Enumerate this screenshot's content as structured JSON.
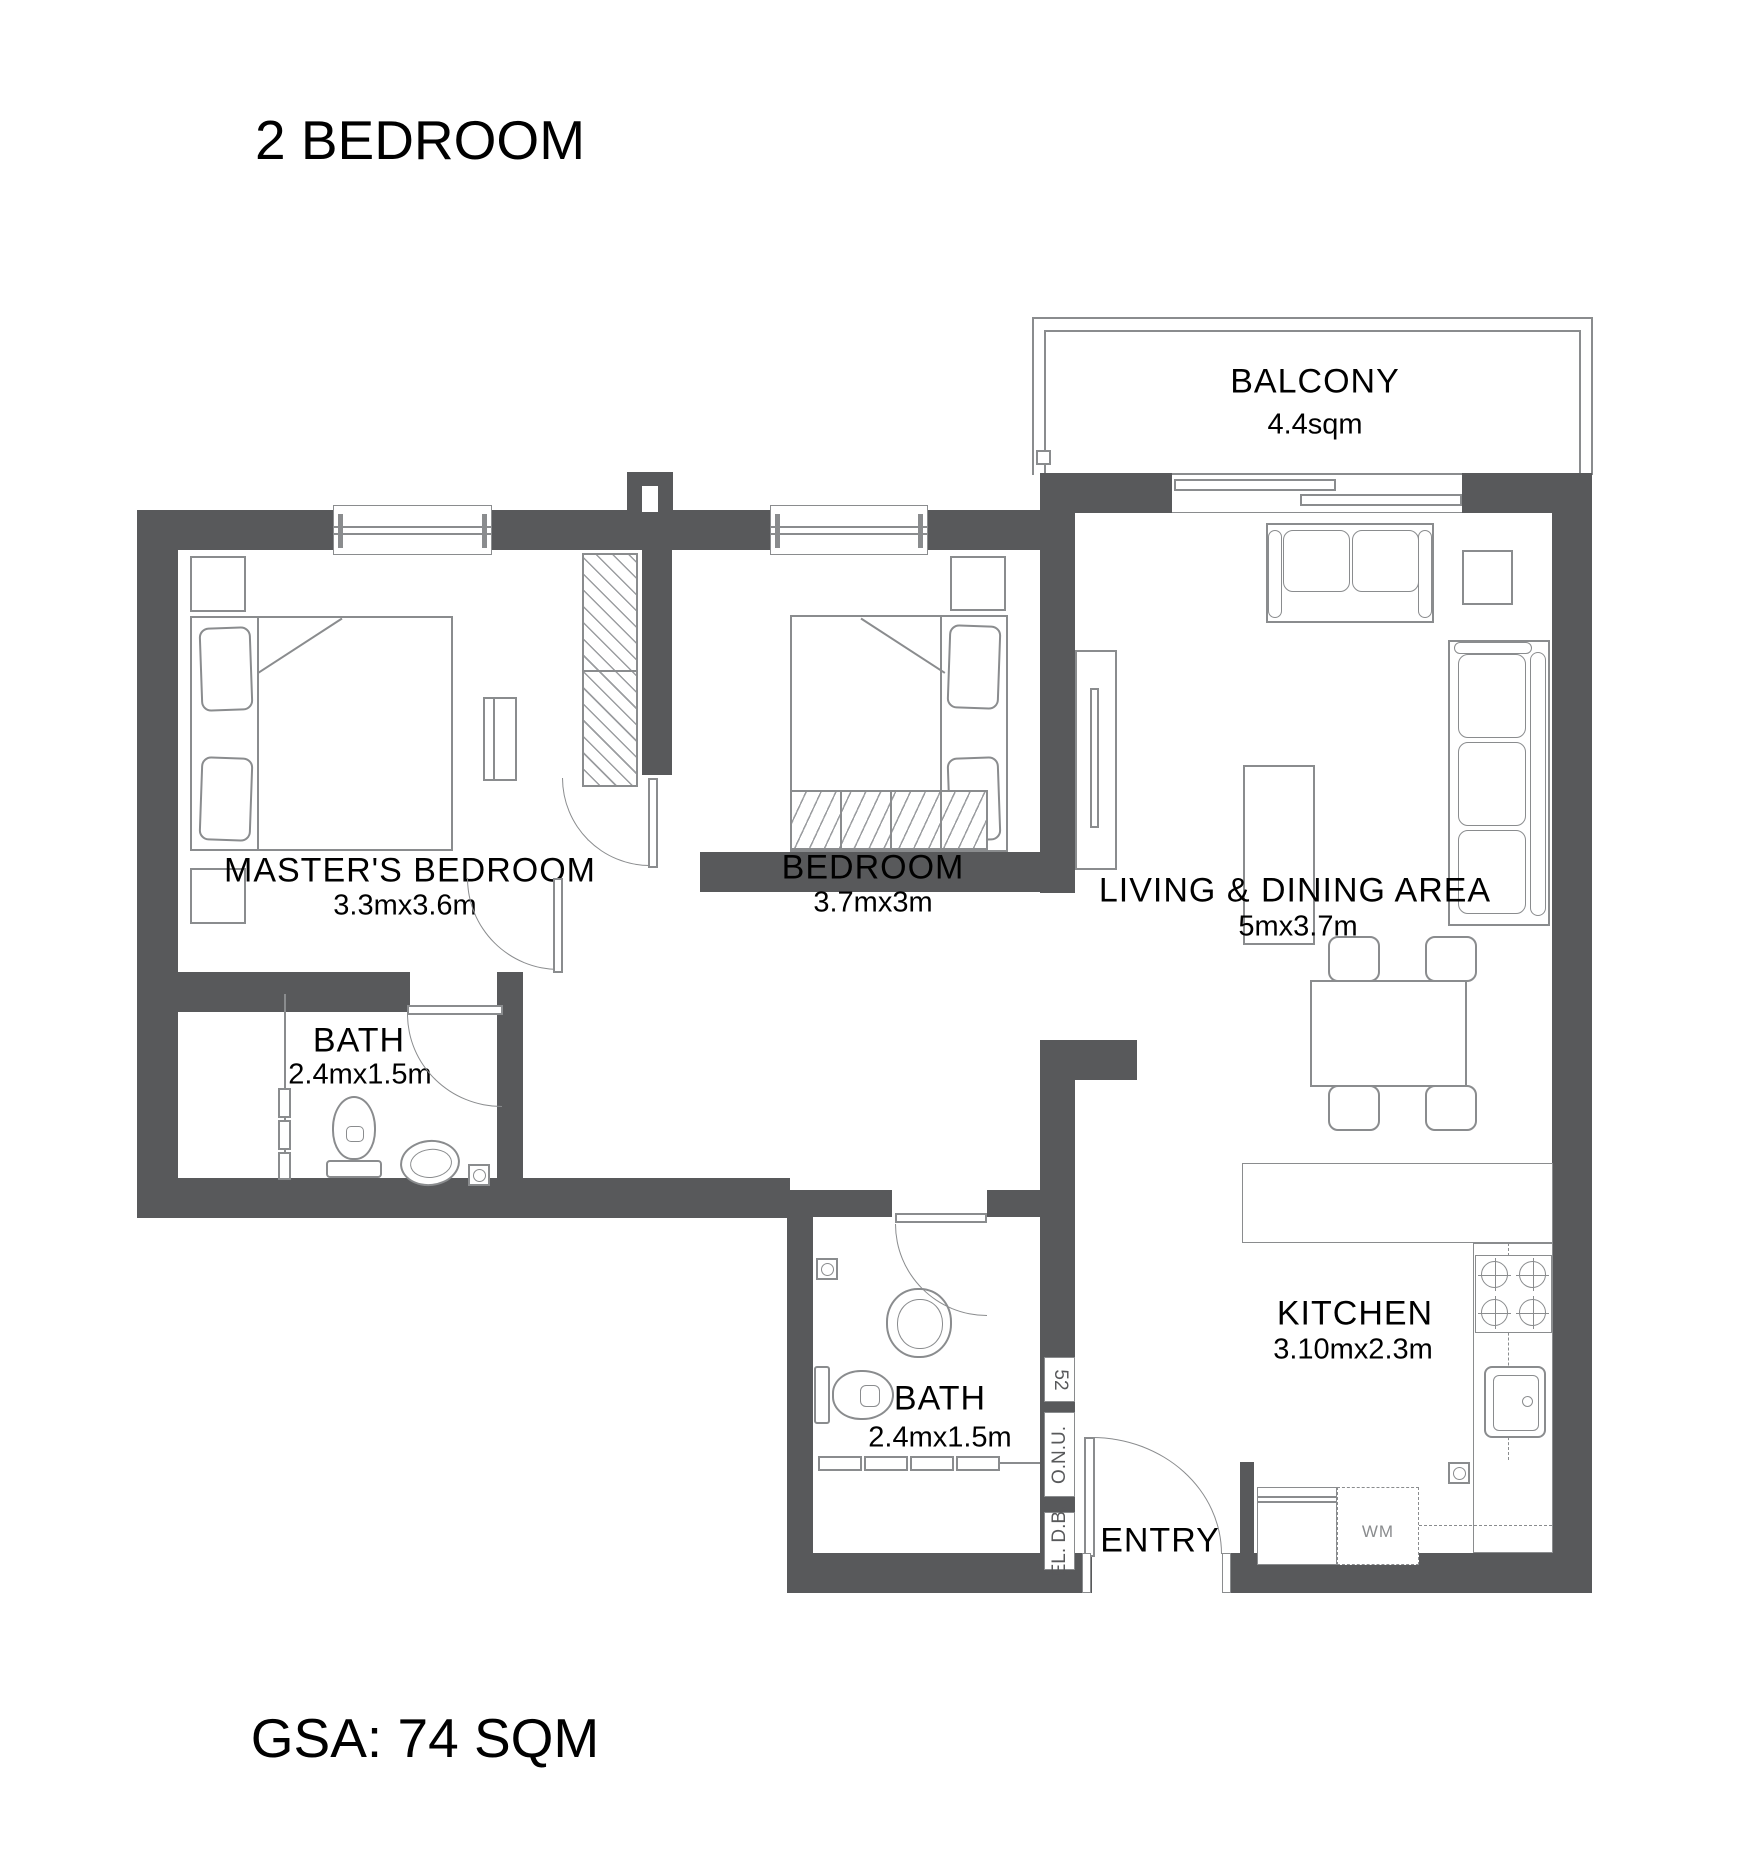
{
  "title": "2 BEDROOM",
  "footer": "GSA: 74 SQM",
  "colors": {
    "wall": "#58595b",
    "furniture_line": "#8a8c8e",
    "text": "#000000"
  },
  "rooms": {
    "balcony": {
      "name": "BALCONY",
      "dims": "4.4sqm"
    },
    "master_bedroom": {
      "name": "MASTER'S BEDROOM",
      "dims": "3.3mx3.6m"
    },
    "bedroom": {
      "name": "BEDROOM",
      "dims": "3.7mx3m"
    },
    "living_dining": {
      "name": "LIVING & DINING AREA",
      "dims": "5mx3.7m"
    },
    "bath_master": {
      "name": "BATH",
      "dims": "2.4mx1.5m"
    },
    "bath_common": {
      "name": "BATH",
      "dims": "2.4mx1.5m"
    },
    "kitchen": {
      "name": "KITCHEN",
      "dims": "3.10mx2.3m"
    },
    "entry": {
      "name": "ENTRY"
    }
  },
  "annotations": {
    "washing_machine": "WM",
    "shaft": "52",
    "onu": "O.N.U.",
    "el_db": "EL. D.B."
  }
}
